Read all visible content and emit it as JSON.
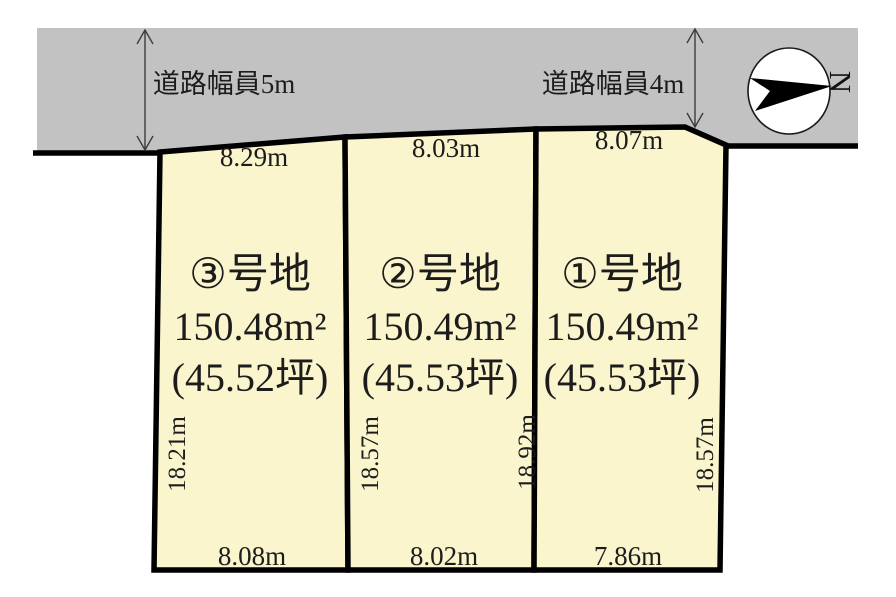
{
  "diagram": {
    "title": "land-subdivision-plan",
    "colors": {
      "road": "#c2c2c2",
      "plot": "#faf5cd",
      "line": "#000000",
      "background": "#ffffff",
      "compass_face": "#ffffff",
      "compass_arrow": "#000000"
    },
    "road": {
      "left_width_label": "道路幅員5m",
      "right_width_label": "道路幅員4m"
    },
    "compass": {
      "letter": "N"
    },
    "plots": [
      {
        "name": "③号地",
        "area": "150.48m²",
        "tsubo": "(45.52坪)"
      },
      {
        "name": "②号地",
        "area": "150.49m²",
        "tsubo": "(45.53坪)"
      },
      {
        "name": "①号地",
        "area": "150.49m²",
        "tsubo": "(45.53坪)"
      }
    ],
    "dimensions": {
      "top": [
        "8.29m",
        "8.03m",
        "8.07m"
      ],
      "bottom": [
        "8.08m",
        "8.02m",
        "7.86m"
      ],
      "sides": [
        "18.21m",
        "18.57m",
        "18.92m",
        "18.57m"
      ]
    }
  }
}
